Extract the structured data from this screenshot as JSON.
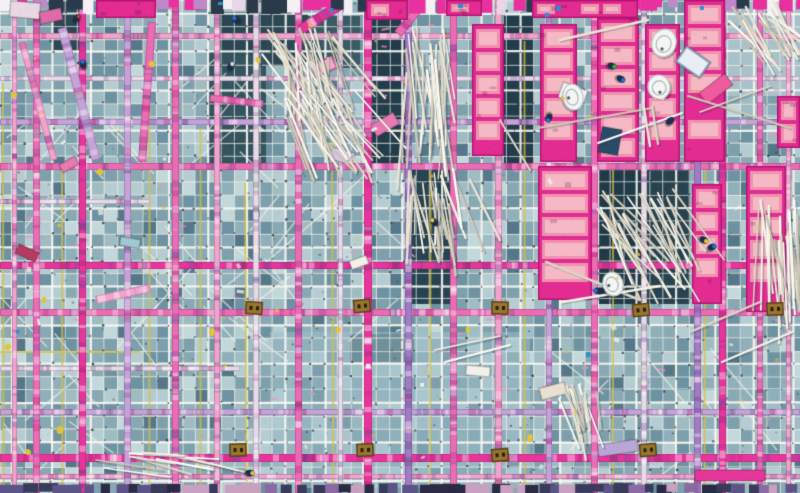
{
  "meta": {
    "description": "Aerial top-down photograph of a construction site: teal rebar mesh decks crossed by a grid of pink and purple formwork beams, bright pink insulation panels, bundles of white pipes, tiny workers and equipment.",
    "width": 800,
    "height": 493,
    "seed": 20240517
  },
  "palette": {
    "cells": [
      "#9fbcc2",
      "#8fb0ba",
      "#7da0ac",
      "#b5cdd2",
      "#6d93a2",
      "#88a9b4"
    ],
    "cellDark": "#54788a",
    "cellLight": "#c2d8da",
    "meshLine": "rgba(242,240,232,0.82)",
    "meshStrong": "rgba(250,248,242,0.95)",
    "meshDot": "#1e3038",
    "beams": {
      "pinkBright": "#e8359b",
      "pink": "#ea6db4",
      "pinkPale": "#f0a4cc",
      "purple": "#9f7cc4",
      "purpleLight": "#c4a4d8",
      "pale": "#e4dce6",
      "purpleDark": "#5c5486"
    },
    "mottle": [
      "rgba(255,255,255,0.40)",
      "rgba(190,40,130,0.35)",
      "rgba(110,70,160,0.30)",
      "rgba(255,215,240,0.45)",
      "rgba(60,40,80,0.20)"
    ],
    "panelBorder": "#e22c92",
    "panelEdge": "#b5156f",
    "panelBlock": "#ef92ae",
    "panelBlockInner": "#f6bfc9",
    "sticks": [
      "#f6f1e4",
      "#ece5d4",
      "#fdfaf2",
      "#ddd6c4",
      "#cfc8b6"
    ],
    "stickShadow": "rgba(40,60,70,0.25)",
    "yellowLine": "#d8c040",
    "yellowBlob": "#e2c437",
    "clamp": "#97762e",
    "clampDark": "#5a431a",
    "workerBody": "#1d2e48",
    "tieDash": "#ee8fc0",
    "paperBit": "#f4f2ec",
    "blueBit": "#2a8fd4",
    "topBand": [
      "#e8319f",
      "#f4f0f4",
      "#2a3a4a",
      "#c088c8",
      "#ead6e6",
      "#e8319f"
    ],
    "bottomBand": [
      "#5c5486",
      "#8a6aa0",
      "#3a3a5a",
      "#c8a0c0",
      "#2a2a44"
    ]
  },
  "mesh": {
    "spacing": 13,
    "strongEvery": 3,
    "dotProb": 0.5,
    "speckCount": 260,
    "tieCount": 70
  },
  "patches": [
    {
      "x": 368,
      "y": 16,
      "w": 38,
      "h": 148,
      "c": "#223c4a"
    },
    {
      "x": 504,
      "y": 16,
      "w": 30,
      "h": 148,
      "c": "#223c4a"
    },
    {
      "x": 208,
      "y": 52,
      "w": 58,
      "h": 112,
      "c": "#33535f"
    },
    {
      "x": 264,
      "y": 14,
      "w": 44,
      "h": 52,
      "c": "#2c4855"
    },
    {
      "x": 308,
      "y": 16,
      "w": 52,
      "h": 52,
      "c": "#3a5a66"
    },
    {
      "x": 406,
      "y": 164,
      "w": 46,
      "h": 140,
      "c": "#27434f"
    },
    {
      "x": 597,
      "y": 164,
      "w": 45,
      "h": 140,
      "c": "#203a48"
    },
    {
      "x": 644,
      "y": 164,
      "w": 46,
      "h": 140,
      "c": "#27434f"
    },
    {
      "x": 52,
      "y": 0,
      "w": 34,
      "h": 50,
      "c": "#2c4855"
    },
    {
      "x": 214,
      "y": 12,
      "w": 52,
      "h": 42,
      "c": "#2a4654"
    },
    {
      "x": 350,
      "y": 334,
      "w": 64,
      "h": 28,
      "c": "#35555f"
    },
    {
      "x": 726,
      "y": 0,
      "w": 74,
      "h": 96,
      "c": "#a9c2ca"
    },
    {
      "x": 270,
      "y": 332,
      "w": 260,
      "h": 156,
      "c": "#9fc0ca",
      "a": 0.55
    }
  ],
  "scaffold": {
    "yellow_vertical_x": [
      3,
      62,
      150,
      200,
      246,
      333,
      430,
      525,
      613,
      705
    ],
    "yellow_segments": [
      {
        "x1": 0,
        "y1": 352,
        "x2": 140,
        "y2": 352
      },
      {
        "x1": 270,
        "y1": 411,
        "x2": 530,
        "y2": 411
      }
    ],
    "diag_regions": [
      {
        "x": 0,
        "y": 52,
        "w": 266,
        "h": 112,
        "n": 12
      },
      {
        "x": 0,
        "y": 166,
        "w": 266,
        "h": 162,
        "n": 16
      },
      {
        "x": 266,
        "y": 166,
        "w": 140,
        "h": 140,
        "n": 8
      },
      {
        "x": 532,
        "y": 332,
        "w": 268,
        "h": 156,
        "n": 9
      },
      {
        "x": 0,
        "y": 332,
        "w": 150,
        "h": 156,
        "n": 7
      }
    ]
  },
  "beams": {
    "vertical": [
      {
        "x": 12,
        "w": 5,
        "c": "pinkPale"
      },
      {
        "x": 33,
        "w": 7,
        "c": "pink"
      },
      {
        "x": 79,
        "w": 7,
        "c": "pinkBright"
      },
      {
        "x": 124,
        "w": 7,
        "c": "purpleLight"
      },
      {
        "x": 172,
        "w": 7,
        "c": "pink"
      },
      {
        "x": 214,
        "w": 6,
        "c": "pinkPale"
      },
      {
        "x": 253,
        "w": 6,
        "c": "pale"
      },
      {
        "x": 295,
        "w": 7,
        "c": "pink"
      },
      {
        "x": 338,
        "w": 5,
        "c": "pale"
      },
      {
        "x": 364,
        "w": 8,
        "c": "pinkBright"
      },
      {
        "x": 405,
        "w": 7,
        "c": "purple"
      },
      {
        "x": 450,
        "w": 7,
        "c": "pink"
      },
      {
        "x": 495,
        "w": 7,
        "c": "pinkPale"
      },
      {
        "x": 546,
        "w": 6,
        "c": "purpleLight"
      },
      {
        "x": 591,
        "w": 7,
        "c": "pink"
      },
      {
        "x": 641,
        "w": 6,
        "c": "pale"
      },
      {
        "x": 694,
        "w": 7,
        "c": "purple"
      },
      {
        "x": 719,
        "w": 7,
        "c": "pinkBright"
      },
      {
        "x": 757,
        "w": 6,
        "c": "pink"
      },
      {
        "x": 786,
        "w": 5,
        "c": "pinkPale"
      }
    ],
    "horizontal": [
      {
        "y": 33,
        "h": 6,
        "c": "pinkPale"
      },
      {
        "y": 76,
        "h": 5,
        "c": "pale"
      },
      {
        "y": 119,
        "h": 6,
        "c": "purpleLight"
      },
      {
        "y": 163,
        "h": 7,
        "c": "pink"
      },
      {
        "y": 199,
        "h": 5,
        "c": "pale",
        "x1": 150
      },
      {
        "y": 262,
        "h": 7,
        "c": "pinkBright"
      },
      {
        "y": 309,
        "h": 7,
        "c": "pink"
      },
      {
        "y": 366,
        "h": 5,
        "c": "pale",
        "x1": 240
      },
      {
        "y": 409,
        "h": 6,
        "c": "purpleLight"
      },
      {
        "y": 454,
        "h": 8,
        "c": "pinkBright"
      },
      {
        "y": 474,
        "h": 5,
        "c": "pinkPale"
      }
    ],
    "tilted": [
      {
        "x1": 62,
        "y1": 28,
        "x2": 96,
        "y2": 160,
        "w": 9,
        "c": "purpleLight"
      },
      {
        "x1": 22,
        "y1": 42,
        "x2": 54,
        "y2": 160,
        "w": 7,
        "c": "pinkPale"
      },
      {
        "x1": 152,
        "y1": 22,
        "x2": 142,
        "y2": 162,
        "w": 8,
        "c": "pink"
      },
      {
        "x1": 345,
        "y1": 2,
        "x2": 300,
        "y2": 30,
        "w": 10,
        "c": "pinkBright"
      },
      {
        "x1": 424,
        "y1": 2,
        "x2": 398,
        "y2": 34,
        "w": 9,
        "c": "pink"
      },
      {
        "x1": 96,
        "y1": 300,
        "x2": 150,
        "y2": 288,
        "w": 8,
        "c": "pinkPale"
      },
      {
        "x1": 210,
        "y1": 98,
        "x2": 263,
        "y2": 104,
        "w": 7,
        "c": "pink"
      }
    ]
  },
  "panels": [
    {
      "x": 366,
      "y": 0,
      "w": 42,
      "h": 20,
      "dir": "h"
    },
    {
      "x": 446,
      "y": 0,
      "w": 36,
      "h": 16,
      "dir": "h"
    },
    {
      "x": 532,
      "y": 0,
      "w": 106,
      "h": 18,
      "dir": "h"
    },
    {
      "x": 96,
      "y": 0,
      "w": 60,
      "h": 18,
      "dir": "h"
    },
    {
      "x": 472,
      "y": 24,
      "w": 32,
      "h": 132,
      "dir": "v"
    },
    {
      "x": 540,
      "y": 24,
      "w": 37,
      "h": 138,
      "dir": "v"
    },
    {
      "x": 597,
      "y": 18,
      "w": 42,
      "h": 144,
      "dir": "v"
    },
    {
      "x": 645,
      "y": 24,
      "w": 35,
      "h": 138,
      "dir": "v"
    },
    {
      "x": 684,
      "y": 0,
      "w": 41,
      "h": 162,
      "dir": "v"
    },
    {
      "x": 777,
      "y": 96,
      "w": 23,
      "h": 52,
      "dir": "v"
    },
    {
      "x": 538,
      "y": 166,
      "w": 54,
      "h": 134,
      "dir": "v"
    },
    {
      "x": 692,
      "y": 184,
      "w": 30,
      "h": 120,
      "dir": "v"
    },
    {
      "x": 746,
      "y": 166,
      "w": 40,
      "h": 146,
      "dir": "v"
    }
  ],
  "stick_bundles": [
    {
      "x": 262,
      "y": 28,
      "w": 72,
      "h": 95,
      "count": 34,
      "angle": 20,
      "spread": 22,
      "lmin": 55,
      "lmax": 95
    },
    {
      "x": 284,
      "y": 88,
      "w": 72,
      "h": 90,
      "count": 30,
      "angle": 28,
      "spread": 20,
      "lmin": 50,
      "lmax": 85
    },
    {
      "x": 402,
      "y": 26,
      "w": 50,
      "h": 130,
      "count": 26,
      "angle": 4,
      "spread": 10,
      "lmin": 70,
      "lmax": 120
    },
    {
      "x": 406,
      "y": 168,
      "w": 50,
      "h": 92,
      "count": 22,
      "angle": 8,
      "spread": 14,
      "lmin": 55,
      "lmax": 88
    },
    {
      "x": 596,
      "y": 188,
      "w": 80,
      "h": 95,
      "count": 26,
      "angle": 30,
      "spread": 18,
      "lmin": 60,
      "lmax": 95
    },
    {
      "x": 756,
      "y": 196,
      "w": 44,
      "h": 118,
      "count": 24,
      "angle": 6,
      "spread": 10,
      "lmin": 70,
      "lmax": 110
    },
    {
      "x": 728,
      "y": 0,
      "w": 70,
      "h": 58,
      "count": 18,
      "angle": 38,
      "spread": 16,
      "lmin": 40,
      "lmax": 66
    },
    {
      "x": 554,
      "y": 384,
      "w": 46,
      "h": 62,
      "count": 14,
      "angle": 18,
      "spread": 14,
      "lmin": 36,
      "lmax": 58
    },
    {
      "x": 126,
      "y": 452,
      "w": 62,
      "h": 18,
      "count": 9,
      "angle": 80,
      "spread": 8,
      "lmin": 40,
      "lmax": 62
    }
  ],
  "loose_sticks": [
    {
      "x1": 688,
      "y1": 96,
      "x2": 790,
      "y2": 128
    },
    {
      "x1": 700,
      "y1": 112,
      "x2": 770,
      "y2": 86
    },
    {
      "x1": 538,
      "y1": 128,
      "x2": 652,
      "y2": 108
    },
    {
      "x1": 560,
      "y1": 40,
      "x2": 648,
      "y2": 20
    },
    {
      "x1": 546,
      "y1": 262,
      "x2": 640,
      "y2": 300
    },
    {
      "x1": 562,
      "y1": 302,
      "x2": 660,
      "y2": 286
    },
    {
      "x1": 598,
      "y1": 143,
      "x2": 682,
      "y2": 113
    },
    {
      "x1": 644,
      "y1": 108,
      "x2": 650,
      "y2": 146
    },
    {
      "x1": 652,
      "y1": 106,
      "x2": 658,
      "y2": 144
    },
    {
      "x1": 435,
      "y1": 350,
      "x2": 500,
      "y2": 336
    },
    {
      "x1": 445,
      "y1": 362,
      "x2": 510,
      "y2": 345
    },
    {
      "x1": 690,
      "y1": 332,
      "x2": 760,
      "y2": 302
    },
    {
      "x1": 722,
      "y1": 362,
      "x2": 792,
      "y2": 332
    },
    {
      "x1": 96,
      "y1": 460,
      "x2": 162,
      "y2": 470
    },
    {
      "x1": 104,
      "y1": 468,
      "x2": 170,
      "y2": 477
    },
    {
      "x1": 500,
      "y1": 120,
      "x2": 530,
      "y2": 170
    },
    {
      "x1": 470,
      "y1": 180,
      "x2": 500,
      "y2": 240
    }
  ],
  "debris": [
    {
      "x": 678,
      "y": 52,
      "w": 30,
      "h": 20,
      "rot": 35,
      "c": "#8fa8c8",
      "c2": "#e8eef4"
    },
    {
      "x": 700,
      "y": 82,
      "w": 32,
      "h": 14,
      "rot": -38,
      "c": "#f05a9e"
    },
    {
      "x": 560,
      "y": 86,
      "w": 26,
      "h": 16,
      "rot": 20,
      "c": "#f4f4f6"
    },
    {
      "x": 372,
      "y": 118,
      "w": 26,
      "h": 13,
      "rot": -30,
      "c": "#e87ab2"
    },
    {
      "x": 330,
      "y": 150,
      "w": 24,
      "h": 12,
      "rot": 15,
      "c": "#d8c8e8"
    },
    {
      "x": 16,
      "y": 248,
      "w": 22,
      "h": 10,
      "rot": 25,
      "c": "#b83a62"
    },
    {
      "x": 540,
      "y": 385,
      "w": 26,
      "h": 12,
      "rot": -15,
      "c": "#e8e0d0"
    },
    {
      "x": 466,
      "y": 366,
      "w": 24,
      "h": 10,
      "rot": 5,
      "c": "#f2f0ea"
    },
    {
      "x": 350,
      "y": 258,
      "w": 18,
      "h": 9,
      "rot": -20,
      "c": "#f2f0ea"
    },
    {
      "x": 600,
      "y": 128,
      "w": 20,
      "h": 26,
      "rot": 10,
      "c": "#2a4a6a"
    },
    {
      "x": 598,
      "y": 442,
      "w": 40,
      "h": 12,
      "rot": -8,
      "c": "#b9a6d6"
    },
    {
      "x": 695,
      "y": 470,
      "w": 70,
      "h": 11,
      "rot": 0,
      "c": "#e8359b"
    },
    {
      "x": 310,
      "y": 60,
      "w": 26,
      "h": 14,
      "rot": -25,
      "c": "#e06aa8",
      "c2": "#f2b0cc"
    },
    {
      "x": 120,
      "y": 238,
      "w": 20,
      "h": 9,
      "rot": 10,
      "c": "#9fc8d2"
    },
    {
      "x": 60,
      "y": 160,
      "w": 18,
      "h": 9,
      "rot": -30,
      "c": "#e87ab2"
    },
    {
      "x": 10,
      "y": 2,
      "w": 30,
      "h": 16,
      "rot": 5,
      "c": "#e8d8e4"
    },
    {
      "x": 40,
      "y": 10,
      "w": 22,
      "h": 12,
      "rot": -12,
      "c": "#e06aa8"
    }
  ],
  "basins": [
    {
      "x": 664,
      "y": 43,
      "rx": 12,
      "ry": 14,
      "rot": 18
    },
    {
      "x": 659,
      "y": 87,
      "rx": 11,
      "ry": 12,
      "rot": -10
    },
    {
      "x": 573,
      "y": 97,
      "rx": 13,
      "ry": 10,
      "rot": 78
    },
    {
      "x": 613,
      "y": 284,
      "rx": 12,
      "ry": 10,
      "rot": 70
    }
  ],
  "clamps": [
    {
      "x": 254,
      "y": 308
    },
    {
      "x": 362,
      "y": 306
    },
    {
      "x": 500,
      "y": 308
    },
    {
      "x": 641,
      "y": 310
    },
    {
      "x": 775,
      "y": 309
    },
    {
      "x": 238,
      "y": 450
    },
    {
      "x": 365,
      "y": 450
    },
    {
      "x": 500,
      "y": 455
    },
    {
      "x": 648,
      "y": 450
    }
  ],
  "workers": [
    {
      "x": 77,
      "y": 18,
      "hc": "#c23a3a"
    },
    {
      "x": 83,
      "y": 64,
      "hc": "#2a6fd4"
    },
    {
      "x": 236,
      "y": 20,
      "hc": "#2a6fd4"
    },
    {
      "x": 231,
      "y": 66,
      "hc": "#d8d8d8"
    },
    {
      "x": 612,
      "y": 66,
      "hc": "#2bb04a"
    },
    {
      "x": 621,
      "y": 79,
      "hc": "#2a6fd4"
    },
    {
      "x": 670,
      "y": 121,
      "hc": "#16335a"
    },
    {
      "x": 704,
      "y": 240,
      "hc": "#e8c53a"
    },
    {
      "x": 712,
      "y": 247,
      "hc": "#2a6fd4"
    },
    {
      "x": 434,
      "y": 222,
      "hc": "#e8c53a"
    },
    {
      "x": 549,
      "y": 118,
      "hc": "#2a6fd4"
    },
    {
      "x": 598,
      "y": 291,
      "hc": "#2a6fd4"
    },
    {
      "x": 250,
      "y": 473,
      "hc": "#e8c53a"
    }
  ],
  "yellow_blobs": [
    {
      "x": 14,
      "y": 95
    },
    {
      "x": 8,
      "y": 347
    },
    {
      "x": 44,
      "y": 300
    },
    {
      "x": 100,
      "y": 172
    },
    {
      "x": 338,
      "y": 330
    },
    {
      "x": 468,
      "y": 330
    },
    {
      "x": 530,
      "y": 438
    },
    {
      "x": 28,
      "y": 452
    },
    {
      "x": 212,
      "y": 332
    },
    {
      "x": 258,
      "y": 60
    },
    {
      "x": 60,
      "y": 430
    },
    {
      "x": 152,
      "y": 64
    }
  ],
  "blue_bits": [
    {
      "x": 330,
      "y": 8
    },
    {
      "x": 556,
      "y": 6
    },
    {
      "x": 545,
      "y": 13
    },
    {
      "x": 700,
      "y": 6
    },
    {
      "x": 458,
      "y": 4
    },
    {
      "x": 586,
      "y": 352
    },
    {
      "x": 16,
      "y": 330
    },
    {
      "x": 218,
      "y": 2
    }
  ],
  "bands": {
    "top": {
      "y": 0,
      "h": 13
    },
    "bottom": {
      "y": 485,
      "h": 8
    }
  },
  "counts": {
    "paper_bits": 22,
    "yellow_specks": 34,
    "grain": 1400
  }
}
